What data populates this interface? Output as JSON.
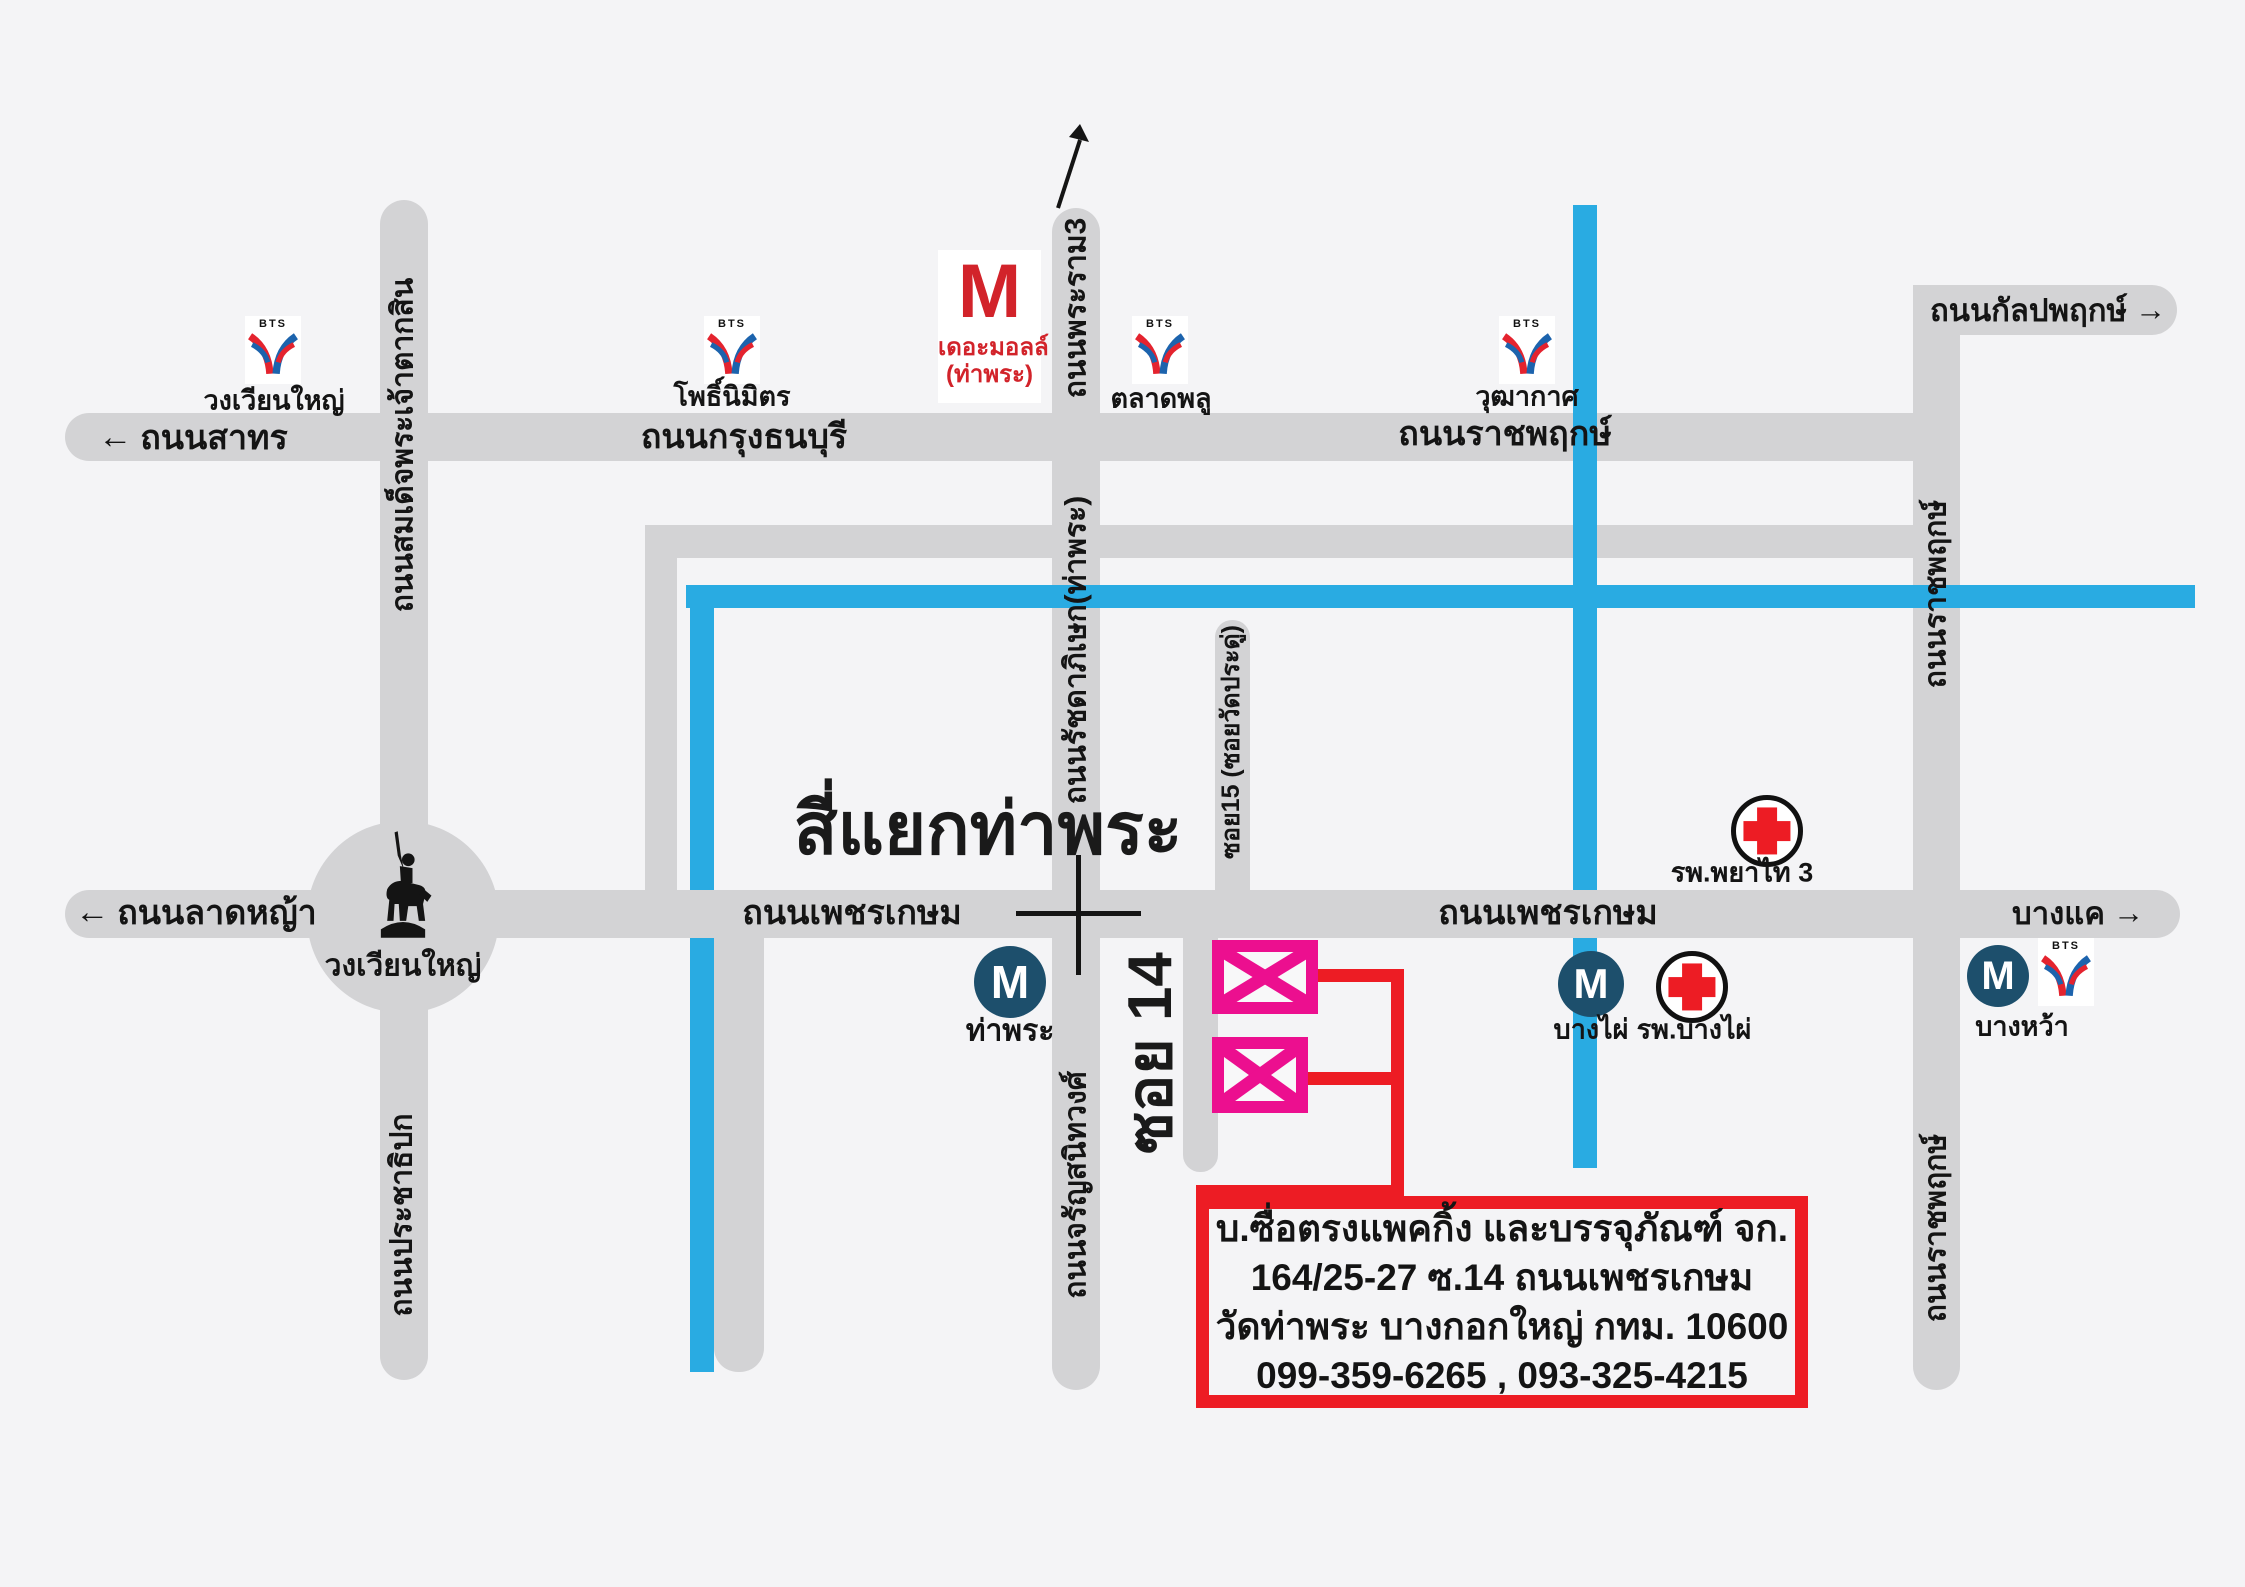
{
  "colors": {
    "background": "#f4f4f6",
    "road_gray": "#d3d3d5",
    "canal_blue": "#29abe2",
    "accent_red": "#ed1c24",
    "marker_pink": "#ec0f8f",
    "mrt_navy": "#1d4f6c",
    "bts_red": "#e4232e",
    "bts_blue": "#1c63ad",
    "mall_red": "#d2232a"
  },
  "icons": {
    "arrow_left": "←",
    "arrow_right": "→"
  },
  "logos": {
    "bts": "BTS",
    "mrt": "M",
    "mall_m": "M"
  },
  "roads": {
    "sathorn": "ถนนสาทร",
    "krung_thonburi": "ถนนกรุงธนบุรี",
    "ratchaphruek_h": "ถนนราชพฤกษ์",
    "kanlapaphruek": "ถนนกัลปพฤกษ์",
    "taksin": "ถนนสมเด็จพระเจ้าตากสิน",
    "prachathipok": "ถนนประชาธิปก",
    "rama3": "ถนนพระราม3",
    "ratchadaphisek": "ถนนรัชดาภิเษก(ท่าพระ)",
    "charansanitwong": "ถนนจรัญสนิทวงศ์",
    "soi15": "ซอย15 (ซอยวัดประดู่)",
    "soi14": "ซอย 14",
    "lat_ya": "ถนนลาดหญ้า",
    "phetkasem_left": "ถนนเพชรเกษม",
    "phetkasem_right": "ถนนเพชรเกษม",
    "bang_khae": "บางแค",
    "ratchaphruek_v_upper": "ถนนราชพฤกษ์",
    "ratchaphruek_v_lower": "ถนนราชพฤกษ์"
  },
  "places": {
    "intersection_title": "สี่แยกท่าพระ",
    "wongwian_yai": "วงเวียนใหญ่",
    "mall_name": "เดอะมอลล์",
    "mall_branch": "(ท่าพระ)",
    "phyathai3_hospital": "รพ.พยาไท 3",
    "bang_phai_hospital": "รพ.บางไผ่"
  },
  "stations": {
    "bts_wongwian_yai": "วงเวียนใหญ่",
    "bts_pho_nimit": "โพธิ์นิมิตร",
    "bts_talat_phlu": "ตลาดพลู",
    "bts_wutthakat": "วุฒากาศ",
    "mrt_tha_phra": "ท่าพระ",
    "mrt_bang_phai": "บางไผ่",
    "bang_wa": "บางหว้า"
  },
  "info_box": {
    "line1": "บ.ซื่อตรงแพคกิ้ง และบรรจุภัณฑ์ จก.",
    "line2": "164/25-27 ซ.14 ถนนเพชรเกษม",
    "line3": "วัดท่าพระ บางกอกใหญ่ กทม. 10600",
    "line4": "099-359-6265 , 093-325-4215"
  }
}
